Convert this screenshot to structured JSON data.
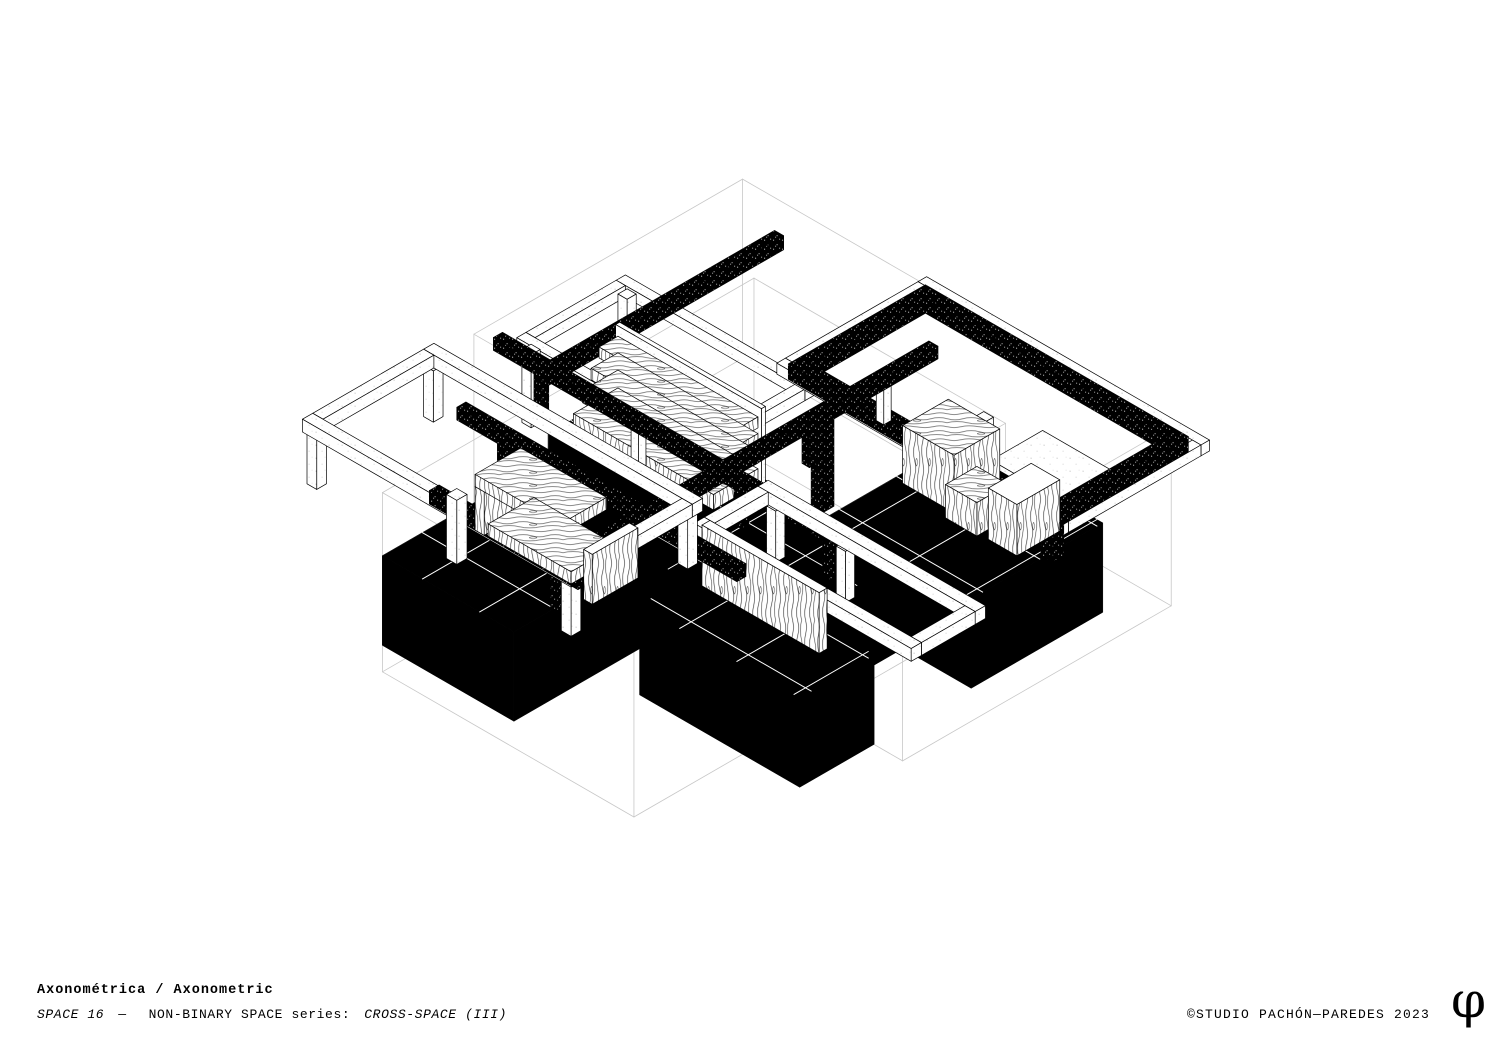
{
  "footer": {
    "title": "Axonométrica / Axonometric",
    "subtitle": {
      "seg1": "SPACE 16",
      "seg2": "—",
      "seg3": "NON-BINARY SPACE series:",
      "seg4": "CROSS-SPACE (III)"
    },
    "copyright": "©STUDIO PACHÓN—PAREDES 2023",
    "logo_glyph": "φ"
  },
  "colors": {
    "ink": "#000000",
    "paper": "#ffffff",
    "wireframe": "#c7c7c7",
    "hairline": "#ffffff"
  },
  "scene": {
    "scale": 66,
    "vscale": 64,
    "center": [
      756,
      498
    ],
    "elements": [
      {
        "t": "wire",
        "name": "envelope-volume-a",
        "min": [
          -0.9,
          -1.8,
          -1.3
        ],
        "size": [
          7.5,
          4.7,
          2.8
        ]
      },
      {
        "t": "wire",
        "name": "envelope-volume-b",
        "min": [
          0.7,
          -0.4,
          -1.3
        ],
        "size": [
          4.4,
          6.5,
          2.8
        ]
      },
      {
        "t": "slab",
        "name": "floor-zone-cabinets",
        "min": [
          3.6,
          -1.1,
          -1.3
        ],
        "size": [
          2.5,
          2.3,
          1.4
        ]
      },
      {
        "t": "slab",
        "name": "floor-zone-shelving",
        "min": [
          -0.1,
          1.2,
          -1.3
        ],
        "size": [
          2.8,
          1.2,
          1.4
        ]
      },
      {
        "t": "slab",
        "name": "floor-zone-center",
        "min": [
          2.0,
          1.2,
          -1.3
        ],
        "size": [
          2.9,
          2.2,
          1.4
        ]
      },
      {
        "t": "slab",
        "name": "floor-zone-bench",
        "min": [
          0.3,
          3.4,
          -1.3
        ],
        "size": [
          2.3,
          2.3,
          1.4
        ]
      },
      {
        "t": "slab",
        "name": "floor-zone-panel",
        "min": [
          3.3,
          2.9,
          -1.3
        ],
        "size": [
          2.8,
          1.3,
          1.4
        ]
      },
      {
        "t": "ring",
        "name": "frame-white-upper-left",
        "rect": [
          -0.55,
          0.6,
          3.3,
          1.9
        ],
        "ztop": 1.42,
        "w": 0.16,
        "h": 0.18,
        "style": "white"
      },
      {
        "t": "box",
        "name": "frame-column-white",
        "min": [
          -0.5,
          0.62,
          0.1
        ],
        "size": [
          0.16,
          0.16,
          1.14
        ],
        "style": "white"
      },
      {
        "t": "box",
        "name": "frame-column-white",
        "min": [
          -0.5,
          2.3,
          0.1
        ],
        "size": [
          0.16,
          0.16,
          1.14
        ],
        "style": "white"
      },
      {
        "t": "box",
        "name": "beam-stippled-left-high",
        "min": [
          0.06,
          -1.4,
          1.18
        ],
        "size": [
          0.16,
          4.1,
          0.22
        ],
        "style": "stip"
      },
      {
        "t": "box",
        "name": "white-side-table",
        "min": [
          4.7,
          -1.45,
          0.55
        ],
        "size": [
          1.4,
          0.9,
          0.09
        ],
        "style": "white"
      },
      {
        "t": "ring",
        "name": "frame-white-upper-right",
        "rect": [
          2.15,
          -1.97,
          4.95,
          2.62
        ],
        "ztop": 1.46,
        "w": 0.15,
        "h": 0.17,
        "style": "white"
      },
      {
        "t": "box",
        "name": "frame-column-white",
        "min": [
          4.5,
          -0.62,
          0.1
        ],
        "size": [
          0.17,
          0.17,
          1.16
        ],
        "style": "white"
      },
      {
        "t": "ring",
        "name": "frame-stippled-upper-right",
        "rect": [
          2.3,
          -1.8,
          4.6,
          2.4
        ],
        "ztop": 1.5,
        "w": 0.2,
        "h": 0.24,
        "style": "stip"
      },
      {
        "t": "box",
        "name": "post-stippled-corner",
        "min": [
          6.66,
          0.34,
          0.72
        ],
        "size": [
          0.2,
          0.2,
          0.54
        ],
        "style": "stip"
      },
      {
        "t": "box",
        "name": "shelving-back-panel",
        "min": [
          0.0,
          1.25,
          0.1
        ],
        "size": [
          2.55,
          0.07,
          1.2
        ],
        "style": "white"
      },
      {
        "t": "box",
        "name": "shelf-slab-4",
        "min": [
          0.05,
          1.33,
          0.98
        ],
        "size": [
          2.45,
          0.33,
          0.17
        ],
        "style": "wood"
      },
      {
        "t": "box",
        "name": "shelf-slab-3",
        "min": [
          0.05,
          1.33,
          0.71
        ],
        "size": [
          2.45,
          0.47,
          0.18
        ],
        "style": "wood"
      },
      {
        "t": "box",
        "name": "shelf-slab-2",
        "min": [
          0.05,
          1.33,
          0.43
        ],
        "size": [
          2.45,
          0.62,
          0.19
        ],
        "style": "wood"
      },
      {
        "t": "box",
        "name": "shelf-slab-1",
        "min": [
          0.05,
          1.33,
          0.1
        ],
        "size": [
          2.45,
          0.78,
          0.24
        ],
        "style": "wood"
      },
      {
        "t": "box",
        "name": "wood-cabinet-tall",
        "min": [
          3.75,
          -0.75,
          0.1
        ],
        "size": [
          0.9,
          0.8,
          0.9
        ],
        "style": "wood"
      },
      {
        "t": "box",
        "name": "wood-cabinet-low",
        "min": [
          4.65,
          -0.35,
          0.1
        ],
        "size": [
          0.55,
          0.55,
          0.52
        ],
        "style": "wood"
      },
      {
        "t": "box",
        "name": "wood-cabinet-right",
        "min": [
          5.35,
          -0.6,
          0.1
        ],
        "size": [
          0.5,
          0.75,
          0.8
        ],
        "style": "woodV"
      },
      {
        "t": "box",
        "name": "column-stippled-center",
        "min": [
          3.3,
          1.0,
          0.1
        ],
        "size": [
          0.2,
          0.2,
          1.4
        ],
        "style": "stip"
      },
      {
        "t": "box",
        "name": "beam-column-stippled",
        "min": [
          -0.6,
          2.02,
          0.1
        ],
        "size": [
          0.13,
          0.13,
          0.56
        ],
        "style": "stip"
      },
      {
        "t": "box",
        "name": "beam-column-white",
        "min": [
          1.1,
          2.02,
          0.1
        ],
        "size": [
          0.13,
          0.13,
          0.56
        ],
        "style": "white"
      },
      {
        "t": "box",
        "name": "beam-column-stippled",
        "min": [
          2.9,
          2.02,
          0.1
        ],
        "size": [
          0.13,
          0.13,
          0.56
        ],
        "style": "stip"
      },
      {
        "t": "box",
        "name": "beam-column-stippled",
        "min": [
          4.45,
          2.02,
          0.1
        ],
        "size": [
          0.13,
          0.13,
          0.56
        ],
        "style": "stip"
      },
      {
        "t": "box",
        "name": "beam-stippled-long-x",
        "min": [
          -1.3,
          2.0,
          0.66
        ],
        "size": [
          6.3,
          0.16,
          0.2
        ],
        "style": "stip"
      },
      {
        "t": "box",
        "name": "beam-column-white",
        "min": [
          2.57,
          -0.8,
          0.1
        ],
        "size": [
          0.13,
          0.13,
          0.56
        ],
        "style": "white"
      },
      {
        "t": "box",
        "name": "beam-column-stippled",
        "min": [
          2.57,
          0.5,
          0.1
        ],
        "size": [
          0.13,
          0.13,
          0.56
        ],
        "style": "stip"
      },
      {
        "t": "box",
        "name": "beam-column-stippled",
        "min": [
          2.57,
          3.9,
          0.1
        ],
        "size": [
          0.13,
          0.13,
          0.56
        ],
        "style": "stip"
      },
      {
        "t": "box",
        "name": "beam-column-stippled",
        "min": [
          2.57,
          4.9,
          0.1
        ],
        "size": [
          0.13,
          0.13,
          0.56
        ],
        "style": "stip"
      },
      {
        "t": "box",
        "name": "beam-stippled-long-y",
        "min": [
          2.56,
          -1.6,
          0.66
        ],
        "size": [
          0.16,
          6.55,
          0.2
        ],
        "style": "stip"
      },
      {
        "t": "box",
        "name": "frame-column-white",
        "min": [
          3.68,
          2.2,
          0.1
        ],
        "size": [
          0.16,
          0.16,
          0.8
        ],
        "style": "white"
      },
      {
        "t": "box",
        "name": "frame-column-white",
        "min": [
          4.9,
          2.2,
          0.1
        ],
        "size": [
          0.16,
          0.16,
          0.8
        ],
        "style": "white"
      },
      {
        "t": "ring",
        "name": "frame-white-right",
        "rect": [
          3.5,
          2.15,
          3.8,
          1.3
        ],
        "ztop": 1.1,
        "w": 0.18,
        "h": 0.2,
        "style": "white"
      },
      {
        "t": "box",
        "name": "wood-wall-panel",
        "min": [
          3.55,
          3.22,
          0.1
        ],
        "size": [
          2.05,
          0.14,
          0.95
        ],
        "style": "woodV"
      },
      {
        "t": "box",
        "name": "beam-column-stippled",
        "min": [
          0.0,
          3.26,
          0.1
        ],
        "size": [
          0.13,
          0.13,
          0.42
        ],
        "style": "stip"
      },
      {
        "t": "box",
        "name": "beam-column-stippled",
        "min": [
          2.2,
          3.26,
          0.1
        ],
        "size": [
          0.13,
          0.13,
          0.42
        ],
        "style": "stip"
      },
      {
        "t": "box",
        "name": "beam-stippled-cross",
        "min": [
          -0.7,
          3.24,
          0.52
        ],
        "size": [
          4.9,
          0.16,
          0.2
        ],
        "style": "stip"
      },
      {
        "t": "box",
        "name": "frame-column-white",
        "min": [
          -1.45,
          3.06,
          0.1
        ],
        "size": [
          0.17,
          0.17,
          0.8
        ],
        "style": "white"
      },
      {
        "t": "box",
        "name": "frame-column-white",
        "min": [
          -1.45,
          5.1,
          0.1
        ],
        "size": [
          0.17,
          0.17,
          0.8
        ],
        "style": "white"
      },
      {
        "t": "box",
        "name": "frame-column-white",
        "min": [
          3.0,
          3.06,
          0.1
        ],
        "size": [
          0.17,
          0.17,
          0.8
        ],
        "style": "white"
      },
      {
        "t": "box",
        "name": "frame-column-white",
        "min": [
          3.0,
          5.1,
          0.1
        ],
        "size": [
          0.17,
          0.17,
          0.8
        ],
        "style": "white"
      },
      {
        "t": "ring",
        "name": "frame-white-left",
        "rect": [
          -1.5,
          3.0,
          4.7,
          2.3
        ],
        "ztop": 1.1,
        "w": 0.18,
        "h": 0.2,
        "style": "white"
      },
      {
        "t": "box",
        "name": "beam-stippled-left-near",
        "min": [
          0.7,
          5.11,
          0.9
        ],
        "size": [
          2.6,
          0.17,
          0.21
        ],
        "style": "stip"
      },
      {
        "t": "box",
        "name": "bench-left-panel",
        "min": [
          0.72,
          3.7,
          0.1
        ],
        "size": [
          0.16,
          0.8,
          0.68
        ],
        "style": "woodV"
      },
      {
        "t": "box",
        "name": "bench-top-slab",
        "min": [
          0.72,
          3.7,
          0.78
        ],
        "size": [
          1.5,
          0.8,
          0.19
        ],
        "style": "wood"
      },
      {
        "t": "box",
        "name": "bench-low-slab",
        "min": [
          1.15,
          3.9,
          0.33
        ],
        "size": [
          1.45,
          0.8,
          0.19
        ],
        "style": "wood"
      },
      {
        "t": "box",
        "name": "bench-right-panel",
        "min": [
          2.72,
          3.8,
          0.1
        ],
        "size": [
          0.15,
          0.8,
          0.78
        ],
        "style": "woodV"
      },
      {
        "t": "box",
        "name": "bench-front-column-white",
        "min": [
          0.9,
          5.0,
          0.1
        ],
        "size": [
          0.18,
          0.18,
          1.0
        ],
        "style": "white"
      }
    ]
  }
}
